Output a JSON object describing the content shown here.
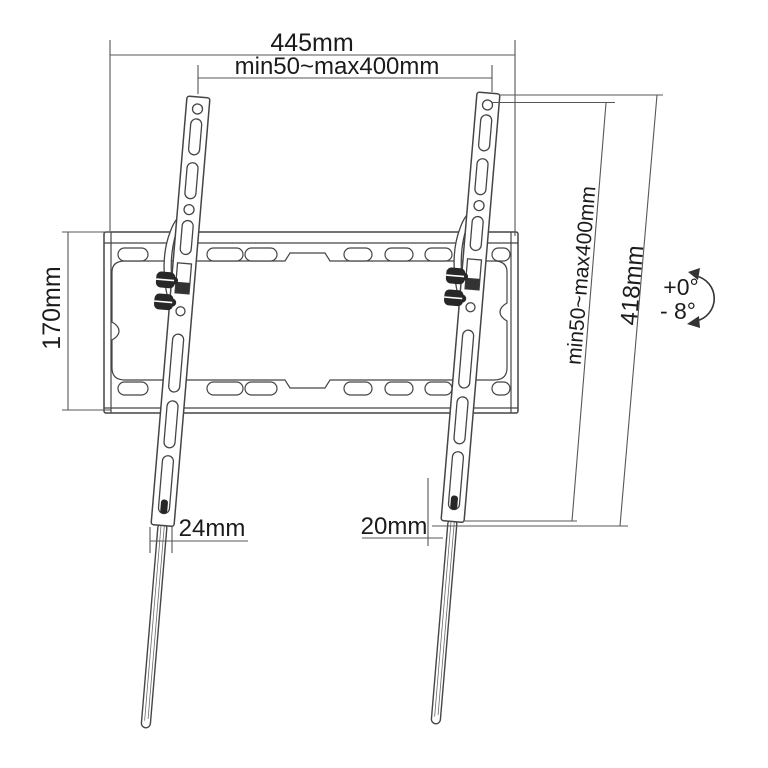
{
  "diagram": {
    "labels": {
      "overall_width": "445mm",
      "vesa_horizontal": "min50~max400mm",
      "plate_height": "170mm",
      "vesa_vertical": "min50~max400mm",
      "bracket_height": "418mm",
      "offset_left": "24mm",
      "offset_right": "20mm",
      "tilt_up": "+0°",
      "tilt_down": "- 8°"
    },
    "colors": {
      "outline": "#454545",
      "dimension": "#575757",
      "text": "#1b1b1b",
      "hardware": "#272727",
      "background": "#ffffff"
    }
  }
}
